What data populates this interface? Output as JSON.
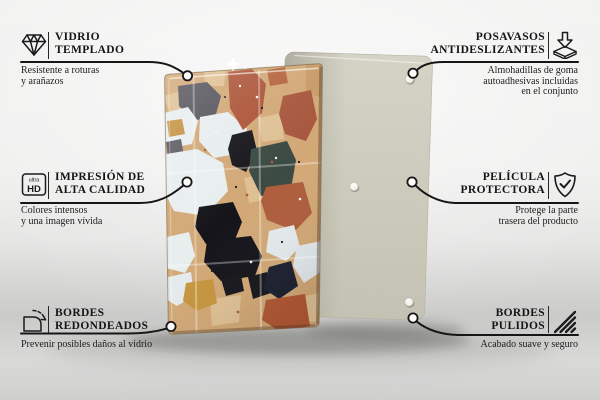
{
  "callouts": {
    "left": [
      {
        "icon": "diamond",
        "title": [
          "VIDRIO",
          "TEMPLADO"
        ],
        "description": [
          "Resistente a roturas",
          "y arañazos"
        ]
      },
      {
        "icon": "ultra-hd",
        "title": [
          "IMPRESIÓN DE",
          "ALTA CALIDAD"
        ],
        "description": [
          "Colores intensos",
          "y una imagen vívida"
        ]
      },
      {
        "icon": "rounded-corner",
        "title": [
          "BORDES",
          "REDONDEADOS"
        ],
        "description": [
          "Prevenir posibles daños al vidrio"
        ]
      }
    ],
    "right": [
      {
        "icon": "coaster-pads",
        "title": [
          "POSAVASOS",
          "ANTIDESLIZANTES"
        ],
        "description": [
          "Almohadillas de goma",
          "autoadhesivas incluidas",
          "en el conjunto"
        ]
      },
      {
        "icon": "shield-check",
        "title": [
          "PELÍCULA",
          "PROTECTORA"
        ],
        "description": [
          "Protege la parte",
          "trasera del producto"
        ]
      },
      {
        "icon": "hatched-edge",
        "title": [
          "BORDES",
          "PULIDOS"
        ],
        "description": [
          "Acabado suave y seguro"
        ]
      }
    ]
  },
  "ultra_hd_icon": {
    "line1": "ultra",
    "line2": "HD"
  },
  "product": {
    "front_panel": "glass board with terrazzo pattern",
    "back_panel": "back panel with anti-slip pads",
    "colors": {
      "line": "#161616",
      "back_panel": "#cbcabb",
      "terrazzo_base": "#d2a876",
      "terracotta": "#ac5538",
      "slate_stone": "#3c4a44",
      "black_stone": "#15151a",
      "white_stone": "#e8eeef",
      "mustard_stone": "#c6953e",
      "gray_stone": "#55545b"
    }
  }
}
